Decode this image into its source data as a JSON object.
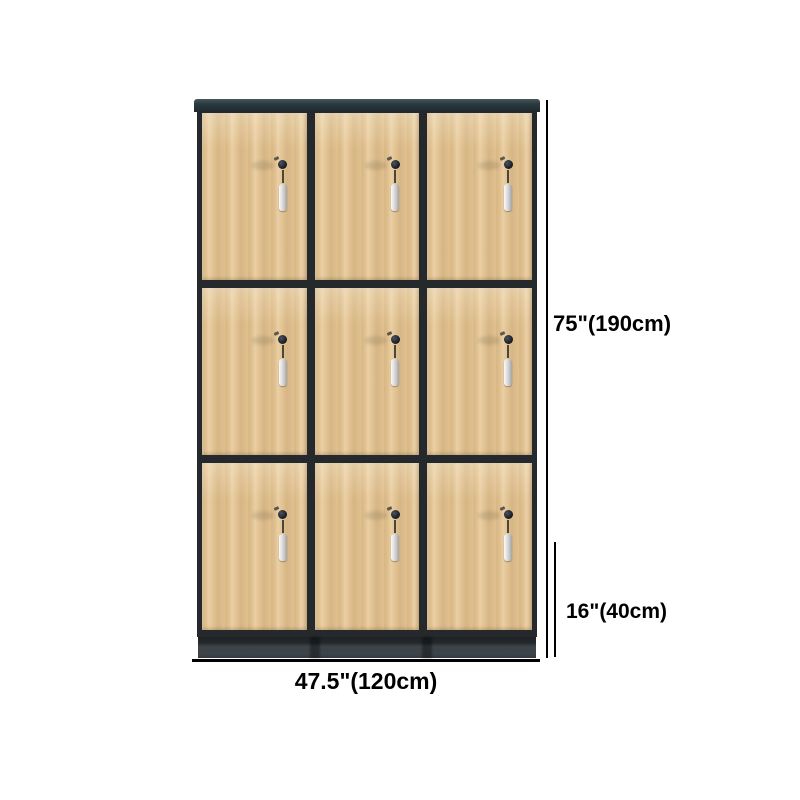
{
  "product": {
    "type": "wooden locker cabinet",
    "rows": 3,
    "cols": 3,
    "doors": 9,
    "lock_with_key_per_door": true
  },
  "annotations": {
    "height_label": "75\"(190cm)",
    "base_height_label": "16\"(40cm)",
    "width_label": "47.5\"(120cm)"
  },
  "colors": {
    "background": "#ffffff",
    "wood": "#e1c190",
    "frame": "#26292b",
    "top_cap": "#2c3b40",
    "plinth": "#3d4449",
    "lock": "#15181d",
    "key_tag": "#d2d2d2",
    "dimension": "#000000"
  }
}
